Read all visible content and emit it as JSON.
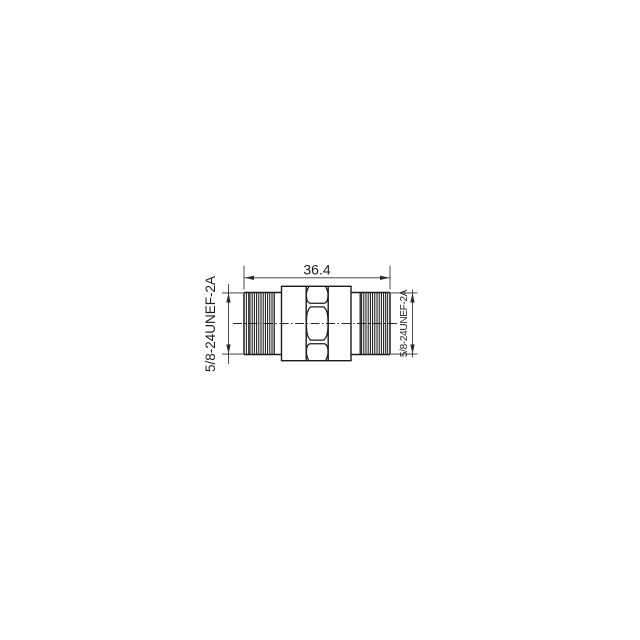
{
  "drawing": {
    "background_color": "#ffffff",
    "line_color": "#1c1c1c",
    "dim_line_color": "#2a2a2a",
    "dimensions": {
      "overall_length": "36.4",
      "left_thread_spec": "5/8-24UNEF-2A",
      "right_thread_spec": "5/8-24UNEF-2A"
    }
  }
}
